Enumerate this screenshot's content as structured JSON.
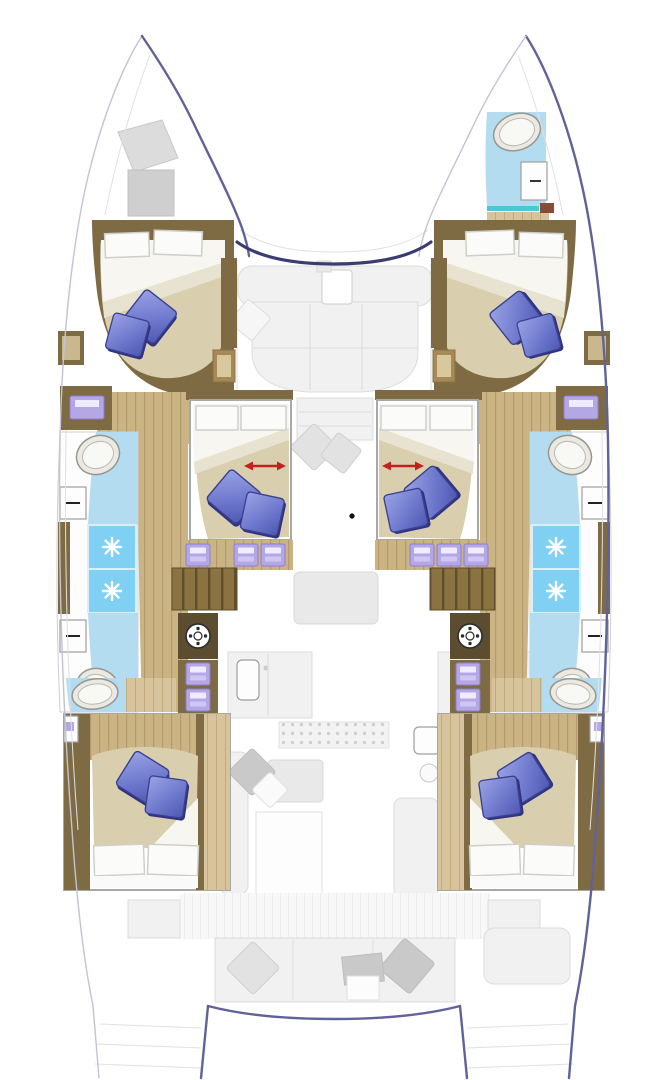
{
  "diagram": {
    "kind": "floor-plan",
    "subject": "sailing catamaran yacht — top-down deck layout",
    "style": "lower-deck cabins drawn in full colour, main-deck salon/galley/cockpit furniture ghosted in light grey"
  },
  "colors": {
    "hull_outline": "#62629a",
    "windscreen": "#3c3c74",
    "wood_dark": "#7e6b43",
    "wood_mid": "#cbb484",
    "wood_light": "#d8c49c",
    "bed_cream": "#d9cfae",
    "sheet_white": "#f7f6f1",
    "pillow_blue": "#6f7ace",
    "pillow_blue_dark": "#31357e",
    "bath_blue": "#b3dcf0",
    "shower_blue": "#7fd0f2",
    "teal_accent": "#49c8d8",
    "lilac": "#b4a7e6",
    "arrow_red": "#c0231f",
    "ghost_fill": "#f1f1f1",
    "ghost_stroke": "#dcdcdc"
  },
  "rooms": [
    {
      "id": "bow-deck-port",
      "label": "port bow deck with hatches"
    },
    {
      "id": "bow-head-starboard",
      "label": "starboard bow head with sink and door"
    },
    {
      "id": "cabin-forward-port",
      "label": "forward port double cabin"
    },
    {
      "id": "cabin-forward-starboard",
      "label": "forward starboard double cabin"
    },
    {
      "id": "cabin-mid-port",
      "label": "mid port cabin with sliding convertible berth"
    },
    {
      "id": "cabin-mid-starboard",
      "label": "mid starboard cabin with sliding convertible berth"
    },
    {
      "id": "bathroom-mid-port",
      "label": "port hull bathroom — two sinks, two shower stalls"
    },
    {
      "id": "bathroom-mid-starboard",
      "label": "starboard hull bathroom — two sinks, two shower stalls"
    },
    {
      "id": "cabin-aft-port",
      "label": "aft port double cabin with en-suite"
    },
    {
      "id": "cabin-aft-starboard",
      "label": "aft starboard double cabin with en-suite"
    },
    {
      "id": "salon",
      "label": "salon with U-shaped sofa and table (ghosted)"
    },
    {
      "id": "galley",
      "label": "galley counters with sink and stove (ghosted)"
    },
    {
      "id": "cockpit",
      "label": "aft cockpit bench with cushions (ghosted)"
    },
    {
      "id": "transom-steps",
      "label": "twin transom swim steps"
    }
  ],
  "features": {
    "double_beds": 6,
    "blue_deco_pillows": 12,
    "white_bed_pillows": 12,
    "shower_stalls": 4,
    "bathroom_sinks": 6,
    "washing_machines": 2,
    "sliding_berth_arrows": 2,
    "lilac_steps": 12,
    "mast_step_dot": 1,
    "hulls": 2
  }
}
